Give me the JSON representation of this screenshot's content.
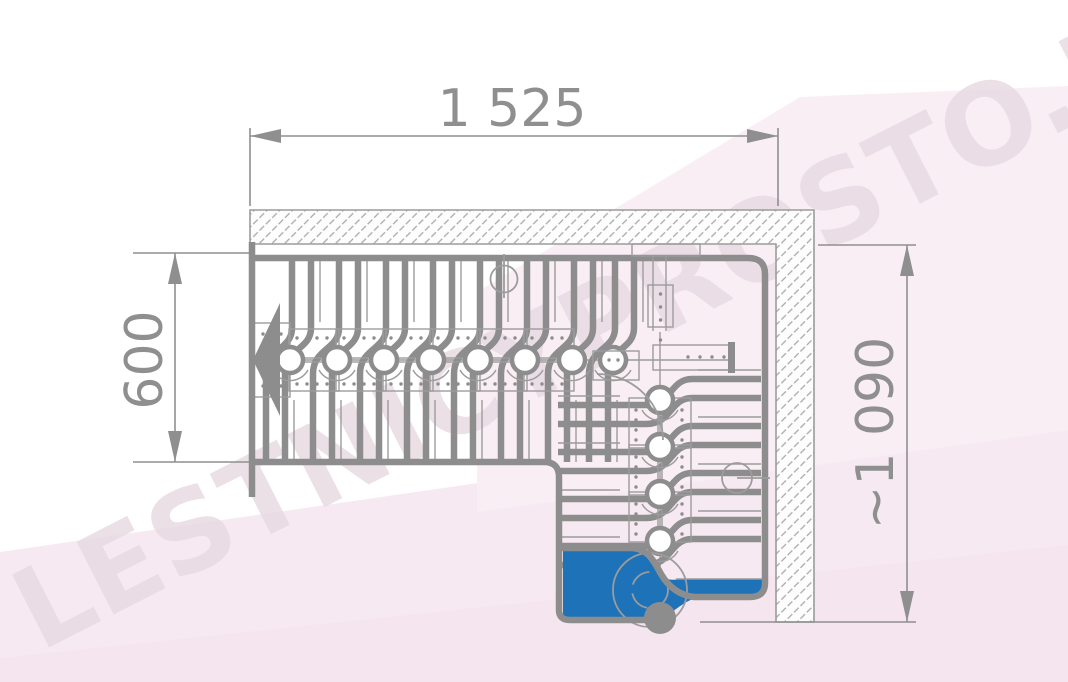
{
  "watermark": {
    "text": "LESTNICYPROSTO.RU"
  },
  "dimensions": {
    "top": {
      "label": "1 525",
      "orientation": "horizontal"
    },
    "left": {
      "label": "600",
      "orientation": "vertical"
    },
    "right": {
      "label": "~1 090",
      "orientation": "vertical"
    }
  },
  "drawing": {
    "kind": "staircase-plan-top-view",
    "straight_flight_nodes": 8,
    "turn_flight_nodes": 4,
    "highlighted_first_step": true
  },
  "colors": {
    "line": "#8d8d8d",
    "line_thin": "#9c9c9c",
    "dimension": "#8f8f8f",
    "step_highlight": "#1e72b8",
    "wall_hatch": "#a9a9a9",
    "background_tint": "#f7e9f1",
    "watermark": "#e8d9e2"
  }
}
